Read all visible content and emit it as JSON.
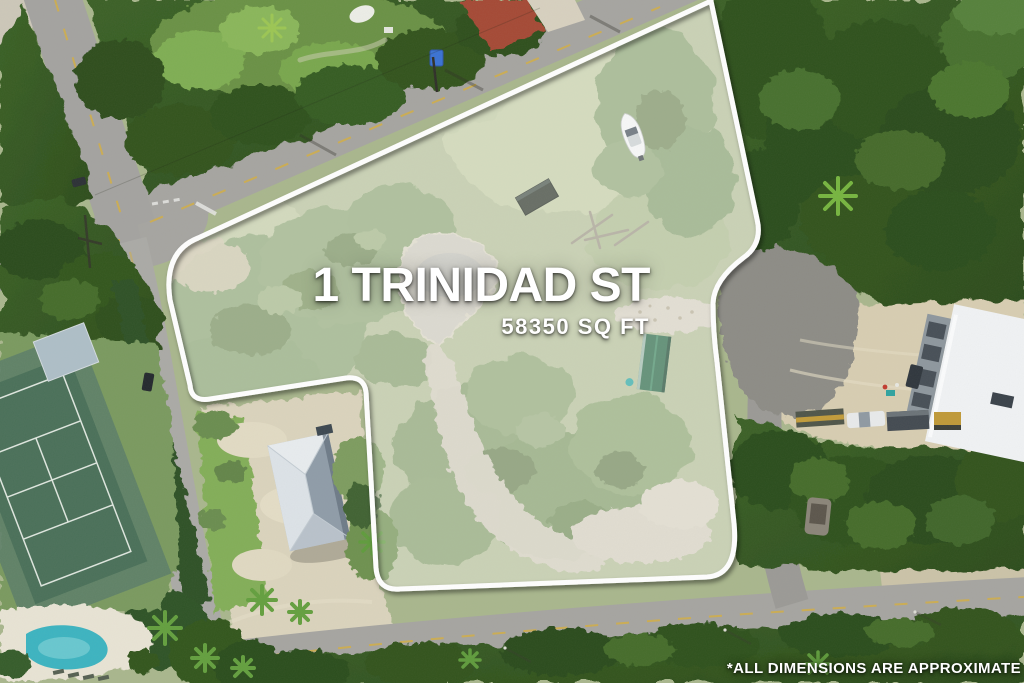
{
  "overlay": {
    "address_title": "1 TRINIDAD ST",
    "lot_area": "58350 SQ FT",
    "disclaimer": "*ALL DIMENSIONS ARE APPROXIMATE"
  },
  "colors": {
    "boundary_line": "#ffffff",
    "overlay_text": "#ffffff",
    "lot_highlight_wash": "#ffffff",
    "forest_green": "#35581f",
    "asphalt_road": "#a6a5a1",
    "cul_de_sac_asphalt": "#8d8c86",
    "sand_lot": "#d8ceb2",
    "pool_water": "#3cb4c1",
    "tennis_court": "#4a7059",
    "house_roof": "#c7d0d8",
    "shed_roof": "#2e6b4b",
    "warehouse_roof": "#f1f3f5"
  },
  "scene": {
    "type": "aerial-drone-photo",
    "features": [
      "property-boundary",
      "vacant-lot",
      "pond",
      "boat",
      "storage-container",
      "green-shed",
      "neighbor-house",
      "driveway",
      "cul-de-sac",
      "warehouse",
      "construction-vehicles",
      "tennis-court",
      "swimming-pool",
      "roads",
      "forest"
    ]
  }
}
